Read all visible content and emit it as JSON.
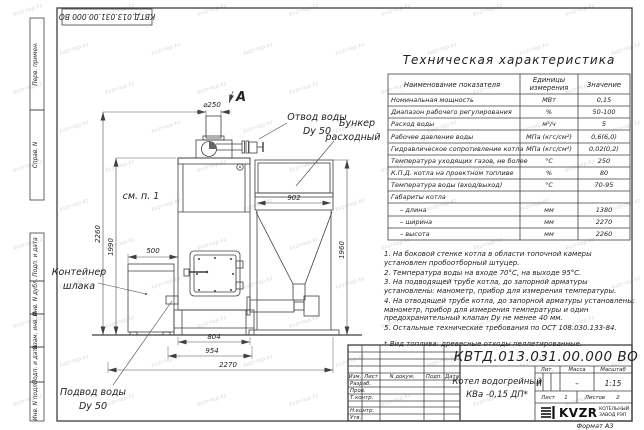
{
  "watermark": "kvzr-rep.kz",
  "frame": {
    "doc_number_rotated": "КВТД.013.031.00.000 ВО",
    "format_label": "Формат А3",
    "side_labels": [
      "Перв. примен.",
      "Справ. N",
      "Подп. и дата",
      "Инв. N дубл.",
      "Взам. инв. N",
      "Подп. и дата",
      "Инв. N подл."
    ]
  },
  "drawing": {
    "view_label": "А",
    "callouts": {
      "outlet_line1": "Отвод воды",
      "outlet_line2": "Dy 50",
      "bunker_line1": "Бункер",
      "bunker_line2": "расходный",
      "see_note": "см. п. 1",
      "container_line1": "Контейнер",
      "container_line2": "шлака",
      "inlet_line1": "Подвод воды",
      "inlet_line2": "Dy 50"
    },
    "dims": {
      "chimney_dia": "⌀250",
      "boiler_height": "2260",
      "jacket_height": "1990",
      "container_width": "500",
      "bunker_width": "902",
      "bunker_height": "1960",
      "base_width": "804",
      "front_width": "954",
      "total_width": "2270"
    }
  },
  "spec_table": {
    "title": "Техническая характеристика",
    "col_name": "Наименование показателя",
    "col_units_line1": "Единицы",
    "col_units_line2": "измерения",
    "col_value": "Значение",
    "rows": [
      {
        "name": "Номинальная мощность",
        "unit": "МВт",
        "value": "0,15"
      },
      {
        "name": "Диапазон рабочего регулирования",
        "unit": "%",
        "value": "50-100"
      },
      {
        "name": "Расход воды",
        "unit": "м³/ч",
        "value": "5"
      },
      {
        "name": "Рабочее давление воды",
        "unit": "МПа (кгс/см²)",
        "value": "0,6(6,0)"
      },
      {
        "name": "Гидравлическое сопротивление котла",
        "unit": "МПа (кгс/см²)",
        "value": "0,02(0,2)"
      },
      {
        "name": "Температура уходящих газов, не более",
        "unit": "°С",
        "value": "250"
      },
      {
        "name": "К.П.Д. котла на проектном топливе",
        "unit": "%",
        "value": "80"
      },
      {
        "name": "Температура воды (вход/выход)",
        "unit": "°С",
        "value": "70-95"
      },
      {
        "name": "Габариты котла",
        "unit": "",
        "value": ""
      },
      {
        "name": "– длина",
        "unit": "мм",
        "value": "1380"
      },
      {
        "name": "– ширина",
        "unit": "мм",
        "value": "2270"
      },
      {
        "name": "– высота",
        "unit": "мм",
        "value": "2260"
      }
    ]
  },
  "notes": [
    "1. На боковой стенке котла в области топочной камеры установлен пробоотборный штуцер.",
    "2. Температура воды на входе 70°С, на выходе 95°С.",
    "3. На подводящей трубе котла, до запорной арматуры установлены: манометр, прибор для измерения температуры.",
    "4. На отводящей трубе котла, до запорной арматуры установлены: манометр, прибор для измерения температуры и один предохранительный клапан Dу не менее 40 мм.",
    "5. Остальные технические требования по ОСТ 108.030.133-84."
  ],
  "fuel_note": "* Вид топлива: древесные отходы пеллетированные.",
  "title_block": {
    "doc_number": "КВТД.013.031.00.000 ВО",
    "product_line1": "Котел водогрейный",
    "product_line2": "КВа -0,15 ДП*",
    "col_izm": "Изм.",
    "col_list": "Лист",
    "col_doc": "N докум.",
    "col_sign": "Подп.",
    "col_date": "Дата",
    "row_developed": "Разраб.",
    "row_checked": "Пров.",
    "row_tcontrol": "Т.контр.",
    "row_ncontrol": "Н.контр.",
    "row_approved": "Утв.",
    "lit_header": "Лит.",
    "mass_header": "Масса",
    "scale_header": "Масштаб",
    "lit_value": "И",
    "mass_value": "–",
    "scale_value": "1:15",
    "sheet_label": "Лист",
    "sheet_value": "1",
    "sheets_label": "Листов",
    "sheets_value": "2",
    "company_abbr": "KVZR",
    "company_line1": "КОТЕЛЬНЫЙ",
    "company_line2": "ЗАВОД РЭП"
  }
}
